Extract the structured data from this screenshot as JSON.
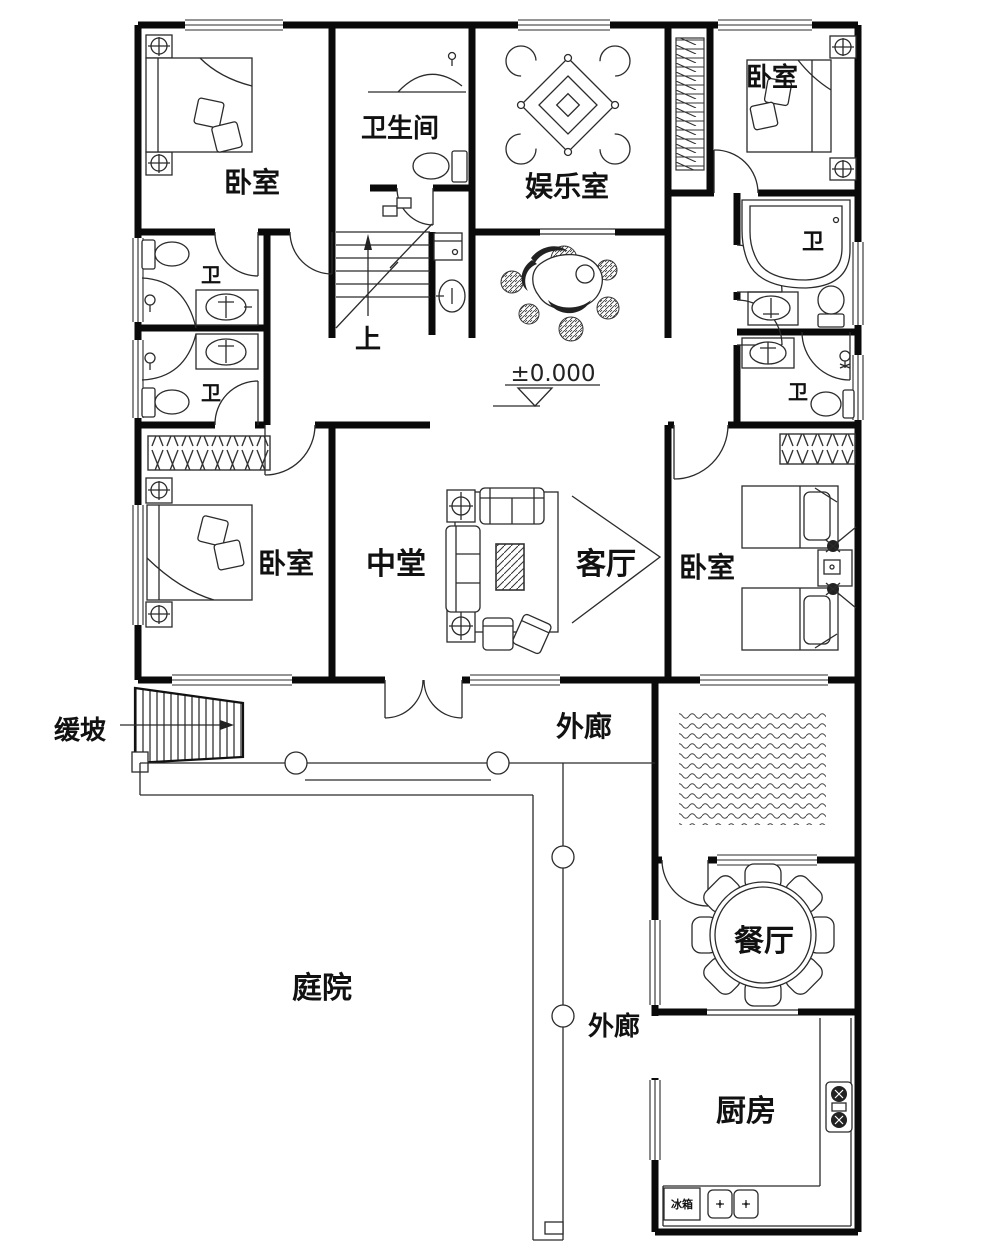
{
  "document": {
    "type": "residential-floor-plan"
  },
  "colors": {
    "ink": "#0a0a0a",
    "line": "#2b2b2b",
    "paper": "#ffffff"
  },
  "labels": {
    "bedroom_top_left": "卧室",
    "bathroom": "卫生间",
    "entertainment_room": "娱乐室",
    "bedroom_top_right": "卧室",
    "wc_right_upper": "卫",
    "wc_right_lower": "卫",
    "wc_left_upper": "卫",
    "wc_left_lower": "卫",
    "stairs_up": "上",
    "elevation": "±0.000",
    "bedroom_mid_left": "卧室",
    "central_hall": "中堂",
    "living_room": "客厅",
    "bedroom_mid_right": "卧室",
    "veranda_upper": "外廊",
    "ramp": "缓坡",
    "courtyard": "庭院",
    "veranda_lower": "外廊",
    "dining_room": "餐厅",
    "kitchen": "厨房",
    "fridge": "冰箱"
  }
}
